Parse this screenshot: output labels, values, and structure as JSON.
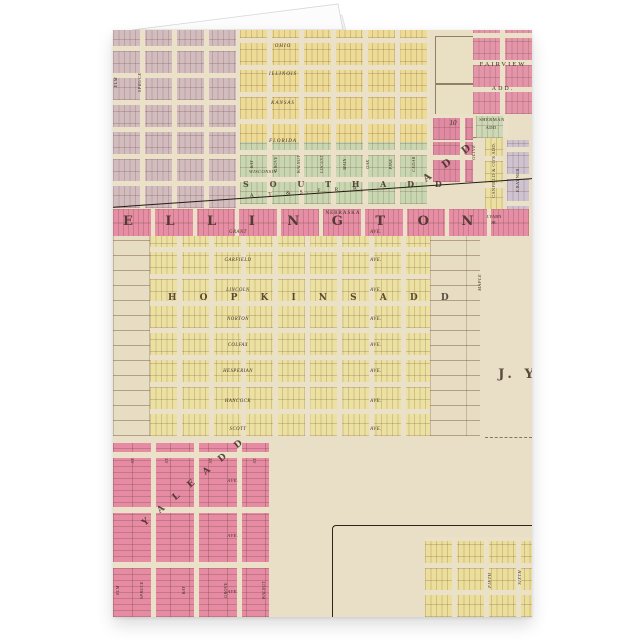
{
  "map": {
    "railroad": "A. T. & S. F. R. R.",
    "town_letters": "E L L I N G T O N",
    "north_add_letters": "S O U T H   A D D",
    "mid_add_letters": "H O P K I N S   A D D",
    "south_add_letters": "Y A L E   A D D",
    "rr_add_letters": "A D D",
    "owner_big": "J. Y",
    "streets_top": [
      "OHIO",
      "ILLINOIS",
      "KANSAS",
      "FLORIDA"
    ],
    "street_wisconsin": "WISCONSIN",
    "street_nebraska": "NEBRASKA",
    "avenues": [
      "GRANT",
      "GARFIELD",
      "LINCOLN",
      "NORTON",
      "COLFAX",
      "HESPERIAN",
      "HANCOCK",
      "SCOTT"
    ],
    "ave_suffix": "AVE.",
    "st_suffix": "ST.",
    "v_left": [
      "ELM",
      "SPRUCE"
    ],
    "v_green": [
      "BAY",
      "GROVE",
      "WALNUT",
      "LOCUST",
      "MAIN",
      "OAK",
      "PINE",
      "CEDAR"
    ],
    "v_right": [
      "OLIVE",
      "MAPLE"
    ],
    "v_bottom": [
      "ELM",
      "SPRUCE",
      "BAY",
      "GROVE",
      "WALNUT"
    ],
    "additions": {
      "fairview_1": "FAIRVIEW",
      "fairview_2": "ADD.",
      "sherman_1": "SHERMAN",
      "sherman_2": "ADD.",
      "canfield": "CANFIELD & CO'S ADD.",
      "yarn_1": "J.YARN",
      "yarn_2": "JR.",
      "rayner": "F.RAYNER"
    },
    "inset_streets": [
      "FIFTH",
      "SIXTH"
    ],
    "block_numbers": [
      "10"
    ]
  }
}
